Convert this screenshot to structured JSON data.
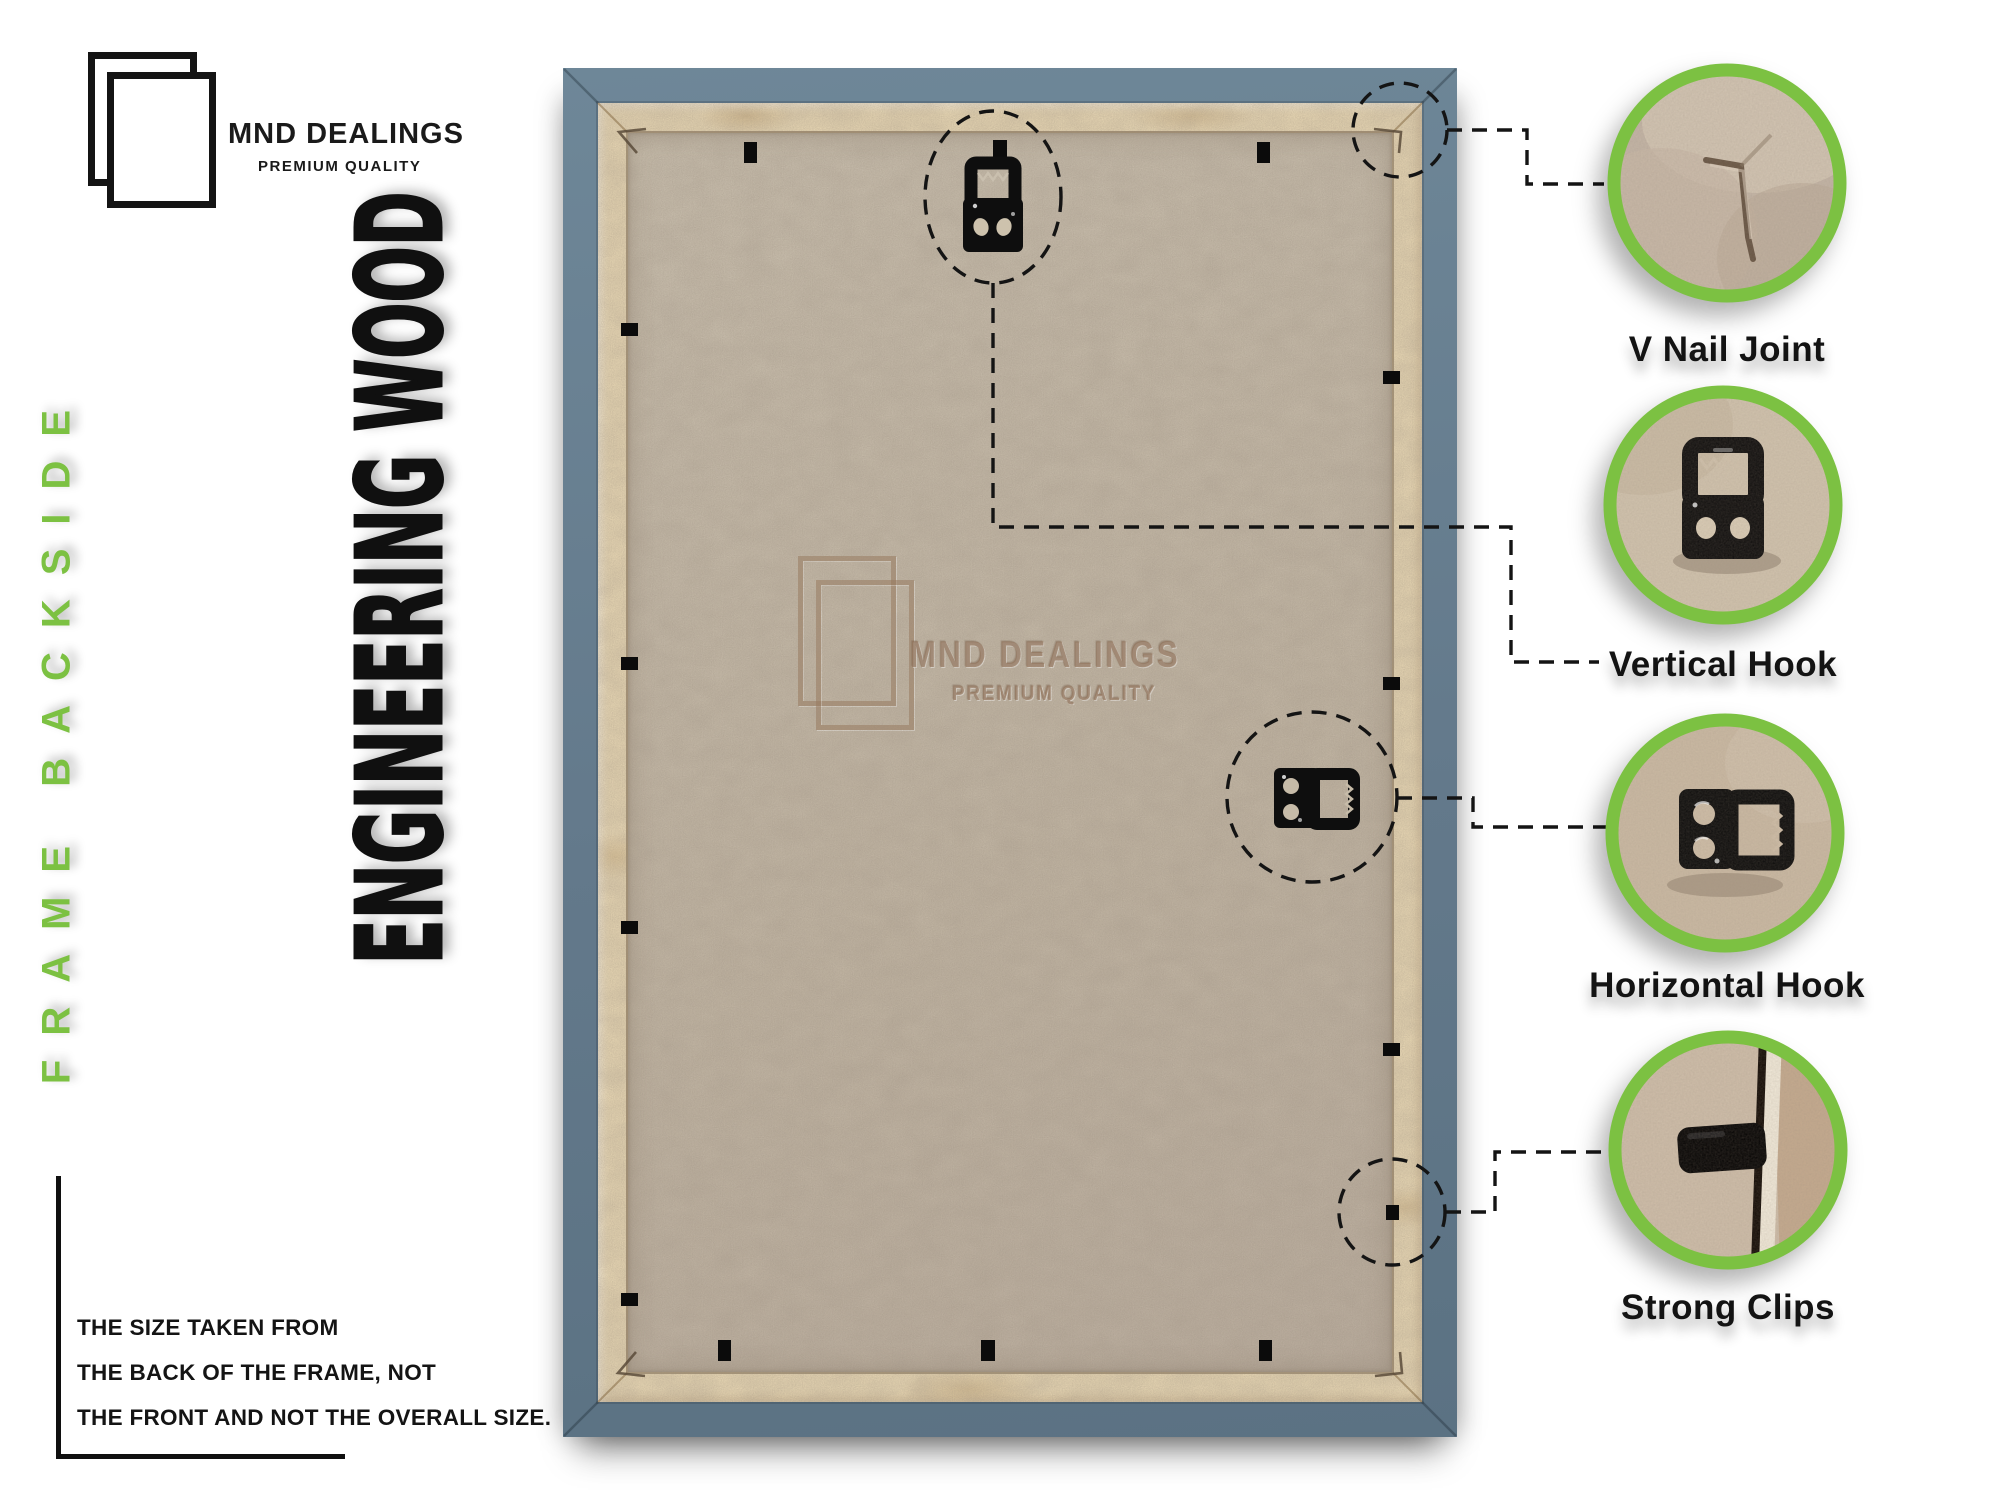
{
  "brand": {
    "name": "MND DEALINGS",
    "tagline": "PREMIUM QUALITY"
  },
  "side_labels": {
    "green_vertical": "FRAME BACKSIDE",
    "black_vertical": "ENGINEERING WOOD"
  },
  "size_note": {
    "lines": [
      "THE SIZE TAKEN FROM",
      "THE BACK OF THE FRAME, NOT",
      "THE FRONT AND NOT THE OVERALL SIZE."
    ]
  },
  "watermark": {
    "name": "MND DEALINGS",
    "tagline": "PREMIUM QUALITY"
  },
  "callouts": [
    {
      "id": "v-nail-joint",
      "label": "V Nail Joint"
    },
    {
      "id": "vertical-hook",
      "label": "Vertical Hook"
    },
    {
      "id": "horizontal-hook",
      "label": "Horizontal Hook"
    },
    {
      "id": "strong-clips",
      "label": "Strong Clips"
    }
  ],
  "colors": {
    "accent_green": "#7cc142",
    "frame_blue": "#64808f",
    "backboard_tan": "#e9d8b4",
    "mdf_board": "#c4baa9",
    "hardware_black": "#0e0e0e",
    "text_black": "#131313"
  }
}
